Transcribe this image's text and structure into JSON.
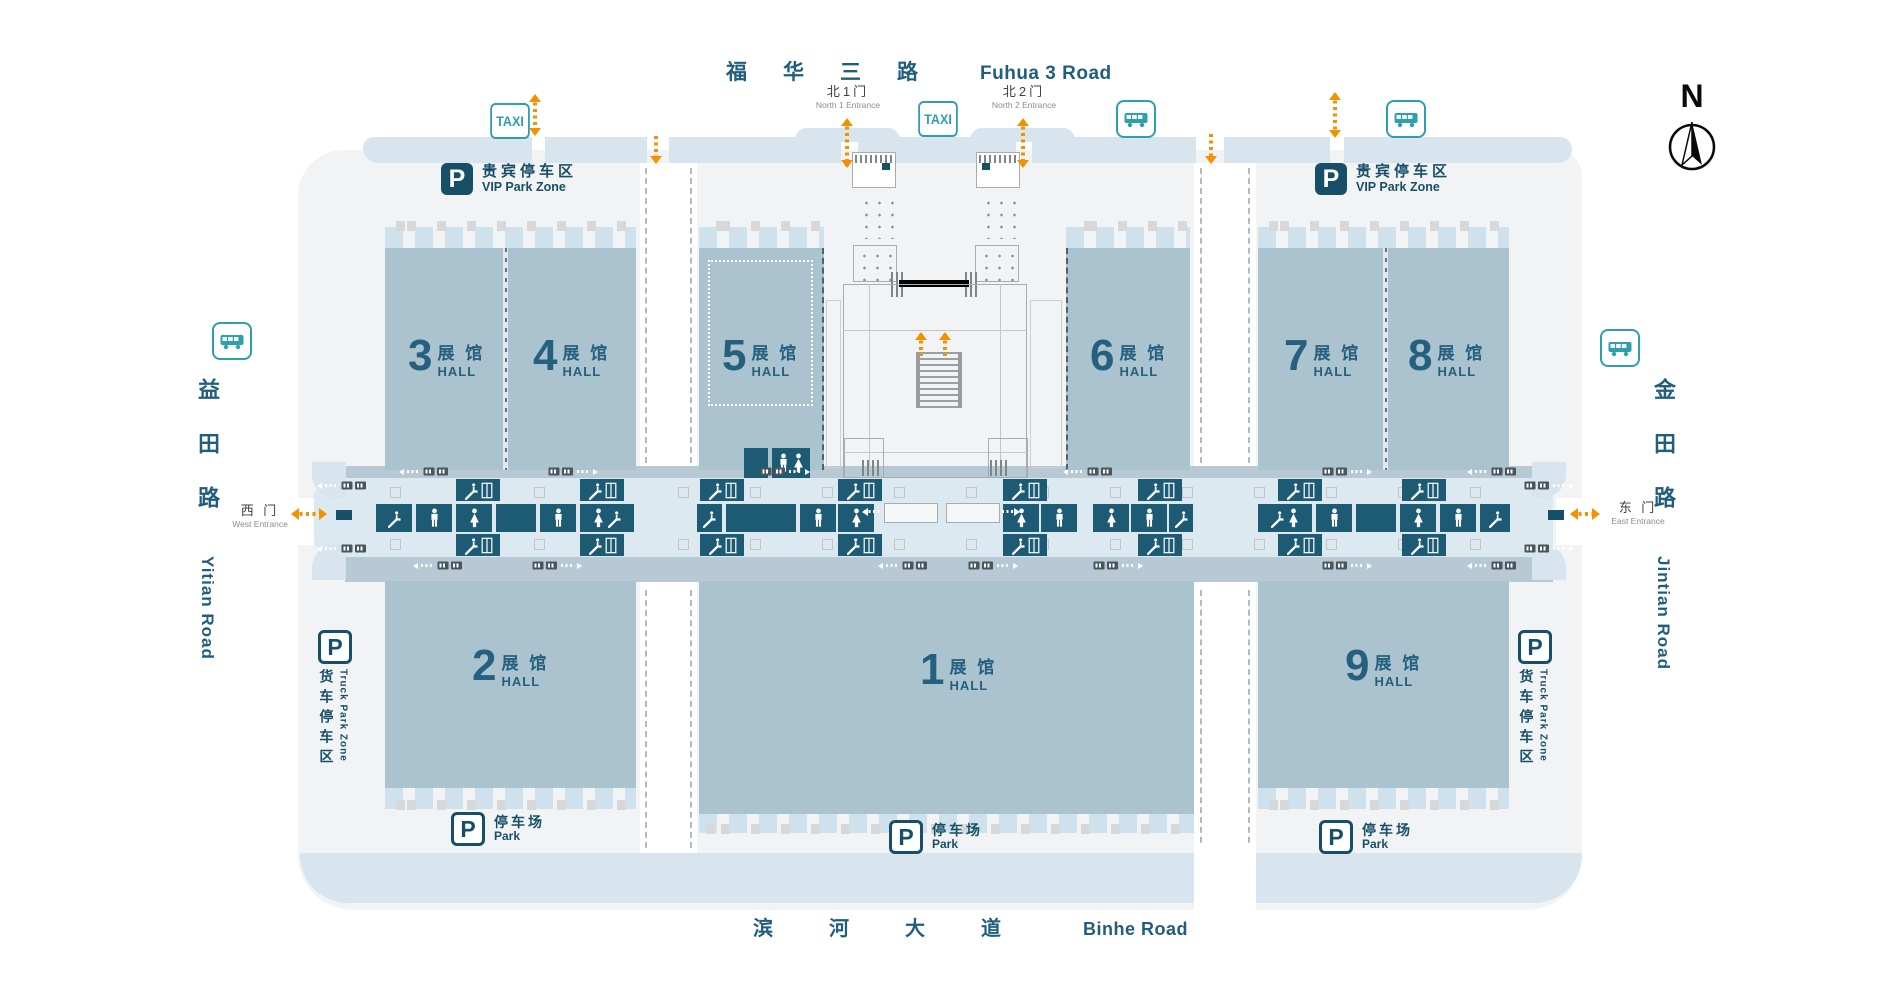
{
  "compass": {
    "label": "N"
  },
  "signs": {
    "taxi": "TAXI",
    "parking_p": "P"
  },
  "roads": {
    "top": {
      "zh": "福华三路",
      "en": "Fuhua 3 Road"
    },
    "bottom": {
      "zh": "滨河大道",
      "en": "Binhe Road"
    },
    "left": {
      "zh": "益田路",
      "en": "Yitian Road"
    },
    "right": {
      "zh": "金田路",
      "en": "Jintian Road"
    }
  },
  "entrances": {
    "north1": {
      "zh": "北1门",
      "en": "North 1 Entrance",
      "x": 802,
      "y": 84
    },
    "north2": {
      "zh": "北2门",
      "en": "North 2 Entrance",
      "x": 978,
      "y": 84
    },
    "west": {
      "zh": "西 门",
      "en": "West Entrance",
      "x": 232,
      "y": 501
    },
    "east": {
      "zh": "东 门",
      "en": "East Entrance",
      "x": 1602,
      "y": 498
    }
  },
  "parking": {
    "vip": {
      "zh": "贵宾停车区",
      "en": "VIP Park Zone"
    },
    "truck": {
      "zh": "货车停车区",
      "en": "Truck Park Zone"
    },
    "park": {
      "zh": "停车场",
      "en": "Park"
    }
  },
  "halls": [
    {
      "num": "1",
      "label_zh": "展 馆",
      "label_en": "HALL",
      "x": 699,
      "y": 581,
      "w": 495,
      "h": 233,
      "lx": 920,
      "ly": 652
    },
    {
      "num": "2",
      "label_zh": "展 馆",
      "label_en": "HALL",
      "x": 385,
      "y": 581,
      "w": 251,
      "h": 207,
      "lx": 472,
      "ly": 648
    },
    {
      "num": "3",
      "label_zh": "展 馆",
      "label_en": "HALL",
      "x": 385,
      "y": 248,
      "w": 118,
      "h": 222,
      "lx": 408,
      "ly": 338
    },
    {
      "num": "4",
      "label_zh": "展 馆",
      "label_en": "HALL",
      "x": 508,
      "y": 248,
      "w": 128,
      "h": 222,
      "lx": 533,
      "ly": 338
    },
    {
      "num": "5",
      "label_zh": "展 馆",
      "label_en": "HALL",
      "x": 699,
      "y": 248,
      "w": 125,
      "h": 222,
      "lx": 722,
      "ly": 338,
      "dashed": "right",
      "inner_dotted": true
    },
    {
      "num": "6",
      "label_zh": "展 馆",
      "label_en": "HALL",
      "x": 1066,
      "y": 248,
      "w": 124,
      "h": 222,
      "lx": 1090,
      "ly": 338,
      "dashed": "left"
    },
    {
      "num": "7",
      "label_zh": "展 馆",
      "label_en": "HALL",
      "x": 1258,
      "y": 248,
      "w": 125,
      "h": 222,
      "lx": 1284,
      "ly": 338
    },
    {
      "num": "8",
      "label_zh": "展 馆",
      "label_en": "HALL",
      "x": 1386,
      "y": 248,
      "w": 123,
      "h": 222,
      "lx": 1408,
      "ly": 338
    },
    {
      "num": "9",
      "label_zh": "展 馆",
      "label_en": "HALL",
      "x": 1258,
      "y": 581,
      "w": 251,
      "h": 207,
      "lx": 1345,
      "ly": 648
    }
  ],
  "hall_dividers": [
    {
      "x": 503,
      "y": 248,
      "h": 222
    },
    {
      "x": 1383,
      "y": 248,
      "h": 222
    }
  ],
  "dock_strips": [
    {
      "x": 385,
      "y": 227,
      "w": 251
    },
    {
      "x": 699,
      "y": 227,
      "w": 125
    },
    {
      "x": 1066,
      "y": 227,
      "w": 124
    },
    {
      "x": 1258,
      "y": 227,
      "w": 251
    },
    {
      "x": 385,
      "y": 788,
      "w": 251
    },
    {
      "x": 1258,
      "y": 788,
      "w": 251
    },
    {
      "x": 699,
      "y": 812,
      "w": 495
    }
  ],
  "gray_rows": [
    {
      "x": 385,
      "y": 221,
      "w": 251
    },
    {
      "x": 699,
      "y": 221,
      "w": 125
    },
    {
      "x": 1066,
      "y": 221,
      "w": 124
    },
    {
      "x": 1258,
      "y": 221,
      "w": 251
    },
    {
      "x": 385,
      "y": 800,
      "w": 251
    },
    {
      "x": 1258,
      "y": 800,
      "w": 251
    },
    {
      "x": 699,
      "y": 824,
      "w": 495
    }
  ],
  "facility_tiles": [
    {
      "x": 456,
      "y": 479,
      "w": 44,
      "h": 22,
      "icon": "esc_elev"
    },
    {
      "x": 580,
      "y": 479,
      "w": 44,
      "h": 22,
      "icon": "esc_elev"
    },
    {
      "x": 376,
      "y": 504,
      "w": 36,
      "h": 28,
      "icon": "escalator"
    },
    {
      "x": 416,
      "y": 504,
      "w": 36,
      "h": 28,
      "icon": "male"
    },
    {
      "x": 456,
      "y": 504,
      "w": 36,
      "h": 28,
      "icon": "female"
    },
    {
      "x": 496,
      "y": 504,
      "w": 40,
      "h": 28,
      "icon": "blank"
    },
    {
      "x": 540,
      "y": 504,
      "w": 36,
      "h": 28,
      "icon": "male"
    },
    {
      "x": 580,
      "y": 504,
      "w": 54,
      "h": 28,
      "icon": "female_esc"
    },
    {
      "x": 456,
      "y": 534,
      "w": 44,
      "h": 22,
      "icon": "esc_elev"
    },
    {
      "x": 580,
      "y": 534,
      "w": 44,
      "h": 22,
      "icon": "esc_elev"
    },
    {
      "x": 744,
      "y": 448,
      "w": 24,
      "h": 30,
      "icon": "blank"
    },
    {
      "x": 772,
      "y": 448,
      "w": 38,
      "h": 30,
      "icon": "mf"
    },
    {
      "x": 700,
      "y": 479,
      "w": 44,
      "h": 22,
      "icon": "esc_elev"
    },
    {
      "x": 838,
      "y": 479,
      "w": 44,
      "h": 22,
      "icon": "esc_elev"
    },
    {
      "x": 697,
      "y": 504,
      "w": 25,
      "h": 28,
      "icon": "escalator"
    },
    {
      "x": 726,
      "y": 504,
      "w": 70,
      "h": 28,
      "icon": "blank"
    },
    {
      "x": 800,
      "y": 504,
      "w": 36,
      "h": 28,
      "icon": "male"
    },
    {
      "x": 838,
      "y": 504,
      "w": 36,
      "h": 28,
      "icon": "female"
    },
    {
      "x": 700,
      "y": 534,
      "w": 44,
      "h": 22,
      "icon": "esc_elev"
    },
    {
      "x": 838,
      "y": 534,
      "w": 44,
      "h": 22,
      "icon": "esc_elev"
    },
    {
      "x": 1003,
      "y": 479,
      "w": 44,
      "h": 22,
      "icon": "esc_elev"
    },
    {
      "x": 1138,
      "y": 479,
      "w": 44,
      "h": 22,
      "icon": "esc_elev"
    },
    {
      "x": 1003,
      "y": 504,
      "w": 36,
      "h": 28,
      "icon": "female"
    },
    {
      "x": 1041,
      "y": 504,
      "w": 36,
      "h": 28,
      "icon": "male"
    },
    {
      "x": 1093,
      "y": 504,
      "w": 36,
      "h": 28,
      "icon": "female"
    },
    {
      "x": 1131,
      "y": 504,
      "w": 36,
      "h": 28,
      "icon": "male"
    },
    {
      "x": 1169,
      "y": 504,
      "w": 24,
      "h": 28,
      "icon": "escalator"
    },
    {
      "x": 1003,
      "y": 534,
      "w": 44,
      "h": 22,
      "icon": "esc_elev"
    },
    {
      "x": 1138,
      "y": 534,
      "w": 44,
      "h": 22,
      "icon": "esc_elev"
    },
    {
      "x": 1278,
      "y": 479,
      "w": 44,
      "h": 22,
      "icon": "esc_elev"
    },
    {
      "x": 1402,
      "y": 479,
      "w": 44,
      "h": 22,
      "icon": "esc_elev"
    },
    {
      "x": 1258,
      "y": 504,
      "w": 54,
      "h": 28,
      "icon": "esc_female"
    },
    {
      "x": 1316,
      "y": 504,
      "w": 36,
      "h": 28,
      "icon": "male"
    },
    {
      "x": 1356,
      "y": 504,
      "w": 40,
      "h": 28,
      "icon": "blank"
    },
    {
      "x": 1400,
      "y": 504,
      "w": 36,
      "h": 28,
      "icon": "female"
    },
    {
      "x": 1440,
      "y": 504,
      "w": 36,
      "h": 28,
      "icon": "male"
    },
    {
      "x": 1480,
      "y": 504,
      "w": 30,
      "h": 28,
      "icon": "escalator"
    },
    {
      "x": 1278,
      "y": 534,
      "w": 44,
      "h": 22,
      "icon": "esc_elev"
    },
    {
      "x": 1402,
      "y": 534,
      "w": 44,
      "h": 22,
      "icon": "esc_elev"
    }
  ],
  "shuttles": [
    {
      "x": 396,
      "y": 467,
      "dir": "left"
    },
    {
      "x": 548,
      "y": 467,
      "dir": "right"
    },
    {
      "x": 760,
      "y": 467,
      "dir": "right"
    },
    {
      "x": 1060,
      "y": 467,
      "dir": "left"
    },
    {
      "x": 1322,
      "y": 467,
      "dir": "right"
    },
    {
      "x": 1464,
      "y": 467,
      "dir": "left"
    },
    {
      "x": 410,
      "y": 561,
      "dir": "left"
    },
    {
      "x": 532,
      "y": 561,
      "dir": "right"
    },
    {
      "x": 875,
      "y": 561,
      "dir": "left"
    },
    {
      "x": 968,
      "y": 561,
      "dir": "right"
    },
    {
      "x": 1093,
      "y": 561,
      "dir": "right"
    },
    {
      "x": 1322,
      "y": 561,
      "dir": "right"
    },
    {
      "x": 1464,
      "y": 561,
      "dir": "left"
    },
    {
      "x": 314,
      "y": 481,
      "dir": "left"
    },
    {
      "x": 314,
      "y": 544,
      "dir": "left"
    },
    {
      "x": 1524,
      "y": 481,
      "dir": "right"
    },
    {
      "x": 1524,
      "y": 544,
      "dir": "right"
    }
  ],
  "column_squares": {
    "rows": [
      487,
      539
    ],
    "x_start": 390,
    "x_step": 72,
    "x_end": 1512
  },
  "bus_stops": [
    {
      "x": 212,
      "y": 322
    },
    {
      "x": 1116,
      "y": 100
    },
    {
      "x": 1386,
      "y": 100
    },
    {
      "x": 1600,
      "y": 329
    }
  ],
  "taxi_stands": [
    {
      "x": 488,
      "y": 103
    },
    {
      "x": 916,
      "y": 101
    }
  ],
  "vip_zones": [
    {
      "x": 441,
      "y": 163
    },
    {
      "x": 1315,
      "y": 163
    }
  ],
  "truck_zones": [
    {
      "x": 318,
      "y": 630
    },
    {
      "x": 1518,
      "y": 630
    }
  ],
  "park_lots": [
    {
      "x": 451,
      "y": 812
    },
    {
      "x": 889,
      "y": 820
    },
    {
      "x": 1319,
      "y": 820
    }
  ],
  "arrows_orange": [
    {
      "x": 533,
      "y": 96,
      "dir": "v",
      "len": 38,
      "heads": "both"
    },
    {
      "x": 654,
      "y": 136,
      "dir": "v",
      "len": 26,
      "heads": "down"
    },
    {
      "x": 845,
      "y": 120,
      "dir": "v",
      "len": 46,
      "heads": "both"
    },
    {
      "x": 1021,
      "y": 120,
      "dir": "v",
      "len": 46,
      "heads": "both"
    },
    {
      "x": 1209,
      "y": 134,
      "dir": "v",
      "len": 28,
      "heads": "down"
    },
    {
      "x": 1333,
      "y": 94,
      "dir": "v",
      "len": 42,
      "heads": "both"
    },
    {
      "x": 919,
      "y": 334,
      "dir": "v",
      "len": 22,
      "heads": "up"
    },
    {
      "x": 943,
      "y": 334,
      "dir": "v",
      "len": 22,
      "heads": "up"
    },
    {
      "x": 293,
      "y": 512,
      "dir": "h",
      "len": 32,
      "heads": "both"
    },
    {
      "x": 1572,
      "y": 512,
      "dir": "h",
      "len": 26,
      "heads": "both"
    }
  ],
  "arrows_white": [
    {
      "x": 864,
      "y": 510,
      "dir": "h",
      "len": 16,
      "heads": "left"
    },
    {
      "x": 1002,
      "y": 510,
      "dir": "h",
      "len": 16,
      "heads": "right"
    }
  ]
}
